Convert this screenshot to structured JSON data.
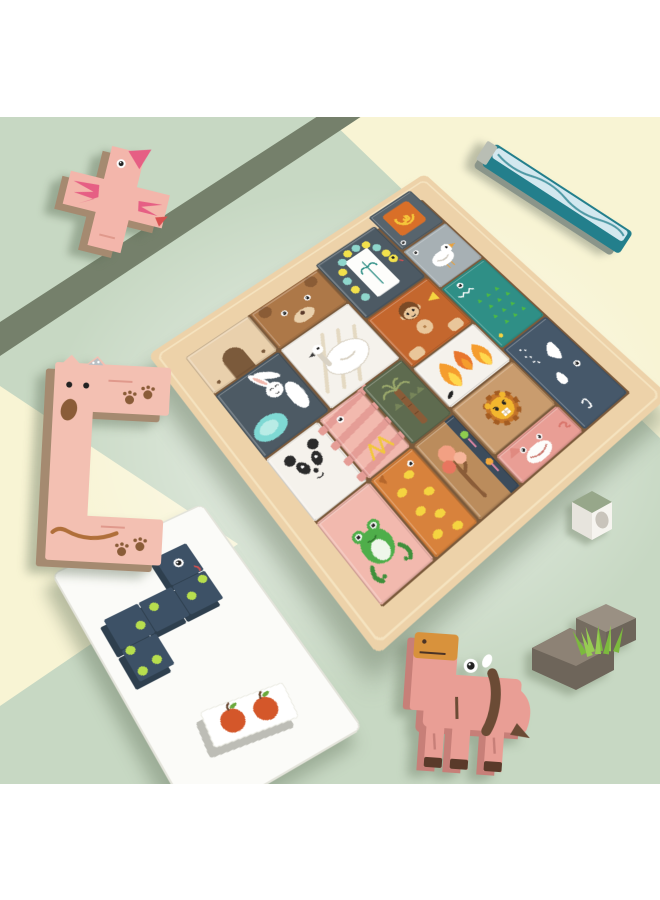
{
  "meta": {
    "description": "Product photo of a wooden animal tetris block puzzle: a tilted square wooden tray filled with colorful animal-themed tetromino blocks (bear, rabbit, snail, monkey, crocodile, panda, frog, leopard, lion, pig, whale, trees), with loose blocks scattered around - a pink bird cross block, a teal river stick, a pink dog block, a white card holding a navy spotted snake block and an apple block, a white egg cube, a gray rock with grass, and a pink horse block - on a mint green and pale yellow backdrop"
  },
  "palette": {
    "white": "#ffffff",
    "mint": "#c7d8c3",
    "mint_glow": "#eaf2e4",
    "pale_yellow": "#f8f4d4",
    "olive_stripe": "#75806b",
    "wood_top": "#edd2a9",
    "wood_edge_hi": "#f8e9c9",
    "well": "#7b5a3b",
    "slate": "#4d5a64",
    "slate_light": "#57646d",
    "steel_blue": "#46586a",
    "white_piece": "#f5f2ec",
    "bear_brown": "#ad7848",
    "arch_tan": "#e9d0ac",
    "rust": "#c4672e",
    "lion_tan": "#c99c6e",
    "lion_yellow": "#f2b62e",
    "mane": "#c4742a",
    "croc_teal": "#2f8f86",
    "leaf_green": "#4cb944",
    "pond_teal": "#7fd9d4",
    "pond_light": "#b9ece6",
    "pink": "#f2b9ae",
    "pink_stripe": "#e59d96",
    "rose": "#e65f84",
    "frog_green": "#4fae4a",
    "leopard": "#d8823c",
    "spot_yellow": "#f5d440",
    "tree_tan": "#bb8c5c",
    "foliage": "#f2a083",
    "foliage_dark": "#e8765f",
    "foliage_light": "#f6b59a",
    "trunk": "#8a5c38",
    "navy": "#3c4c5c",
    "lolli_green": "#8fce4e",
    "lolli_orange": "#f2a83c",
    "stem_pink": "#e88ba8",
    "horse_pink": "#e99e95",
    "muzzle_orange": "#d8923c",
    "dark_brown": "#6b4b35",
    "snake_navy": "#3d5166",
    "snake_side": "#2e3f4e",
    "lime": "#b7de4e",
    "stick_teal": "#237f8c",
    "stick_ice": "#d3e8ef",
    "rock_top": "#8d8275",
    "rock_side": "#6e655a",
    "grass_green": "#7cb93e",
    "grass_light": "#97cc52",
    "apple_red": "#d4572a",
    "palm_bg": "#5e6b4f",
    "bead_teal": "#8fd6cc",
    "bead_yellow": "#f2e14c",
    "side_shade": "#a58a70",
    "tray_white": "#fbfbf8",
    "cube_top": "#97a78a",
    "egg_gray": "#c9c4bb",
    "monkey_tan": "#e9c69a",
    "monkey_cap": "#7a4a26",
    "flame_orange": "#f59d2e",
    "flame_yellow": "#ffd84d"
  },
  "board": {
    "pieces": [
      {
        "name": "wood-arch-piece",
        "motif": "arch",
        "fill": "#e9d0ac",
        "gx": 0,
        "gy": 0,
        "gw": 1.5,
        "gh": 1.05
      },
      {
        "name": "bear-piece",
        "motif": "bear",
        "fill": "#ad7848",
        "gx": 1.5,
        "gy": 0,
        "gw": 1.7,
        "gh": 1.05
      },
      {
        "name": "bead-snake-piece",
        "motif": "beads",
        "fill": "#4d5a64",
        "gx": 3.2,
        "gy": -0.1,
        "gw": 1.6,
        "gh": 1.7
      },
      {
        "name": "snail-piece",
        "motif": "snail",
        "fill": "#57646d",
        "gx": 4.8,
        "gy": -0.35,
        "gw": 1.2,
        "gh": 1.15
      },
      {
        "name": "gray-bird-piece",
        "motif": "birdgray",
        "fill": "#a7b0b4",
        "gx": 4.8,
        "gy": 0.8,
        "gw": 1.2,
        "gh": 1.2
      },
      {
        "name": "rabbit-piece",
        "motif": "rabbit",
        "fill": "#4d5a64",
        "gx": 0,
        "gy": 1.05,
        "gw": 1.5,
        "gh": 1.65
      },
      {
        "name": "goose-piece",
        "motif": "goose",
        "fill": "#f5f2ec",
        "gx": 1.5,
        "gy": 1.05,
        "gw": 1.7,
        "gh": 1.65
      },
      {
        "name": "monkey-piece",
        "motif": "monkey",
        "fill": "#c4672e",
        "gx": 3.2,
        "gy": 1.6,
        "gw": 1.6,
        "gh": 1.4
      },
      {
        "name": "crocodile-piece",
        "motif": "croc",
        "fill": "#2f8f86",
        "gx": 4.8,
        "gy": 2.0,
        "gw": 1.2,
        "gh": 1.8
      },
      {
        "name": "panda-piece",
        "motif": "panda",
        "fill": "#f5f2ec",
        "gx": 0,
        "gy": 2.7,
        "gw": 1.2,
        "gh": 1.5
      },
      {
        "name": "striped-piece",
        "motif": "stripes",
        "fill": "#f2b9ae",
        "gx": 1.2,
        "gy": 2.7,
        "gw": 1.0,
        "gh": 1.5
      },
      {
        "name": "palm-piece",
        "motif": "palm",
        "fill": "#5e6b4f",
        "gx": 2.2,
        "gy": 2.7,
        "gw": 1.0,
        "gh": 1.5
      },
      {
        "name": "flame-piece",
        "motif": "flames",
        "fill": "#f5f2ec",
        "gx": 3.2,
        "gy": 3.0,
        "gw": 1.6,
        "gh": 1.1
      },
      {
        "name": "frog-piece",
        "motif": "frog",
        "fill": "#f2b9ae",
        "gx": 0,
        "gy": 4.2,
        "gw": 1.2,
        "gh": 1.8
      },
      {
        "name": "leopard-piece",
        "motif": "spots",
        "fill": "#d8823c",
        "gx": 1.2,
        "gy": 4.2,
        "gw": 1.0,
        "gh": 1.8
      },
      {
        "name": "autumn-tree-piece",
        "motif": "tree",
        "fill": "#bb8c5c",
        "gx": 2.2,
        "gy": 4.2,
        "gw": 1.0,
        "gh": 1.8
      },
      {
        "name": "lion-piece",
        "motif": "lion",
        "fill": "#c99c6e",
        "gx": 3.2,
        "gy": 4.1,
        "gw": 1.6,
        "gh": 1.2
      },
      {
        "name": "pig-piece",
        "motif": "pig",
        "fill": "#e99e95",
        "gx": 3.2,
        "gy": 5.3,
        "gw": 1.6,
        "gh": 0.7
      },
      {
        "name": "whale-piece",
        "motif": "whale",
        "fill": "#46586a",
        "gx": 4.8,
        "gy": 3.8,
        "gw": 1.2,
        "gh": 2.2
      }
    ]
  },
  "loose_pieces": [
    {
      "name": "bird-cross-block",
      "fill": "#f3b6ab",
      "accent": "#e65f84"
    },
    {
      "name": "river-stick-block",
      "fill": "#237f8c",
      "accent": "#d3e8ef"
    },
    {
      "name": "dog-block",
      "fill": "#f3c0b2",
      "accent": "#8a5c38"
    },
    {
      "name": "white-tray-card",
      "fill": "#fbfbf8"
    },
    {
      "name": "snake-block",
      "fill": "#3d5166",
      "accent": "#b7de4e"
    },
    {
      "name": "apple-block",
      "fill": "#ffffff",
      "accent": "#d4572a"
    },
    {
      "name": "egg-cube",
      "fill": "#f6f4ef",
      "accent": "#c9c4bb"
    },
    {
      "name": "rock-grass-block",
      "fill": "#8d8275",
      "accent": "#7cb93e"
    },
    {
      "name": "horse-block",
      "fill": "#e99e95",
      "accent": "#d8923c"
    }
  ]
}
